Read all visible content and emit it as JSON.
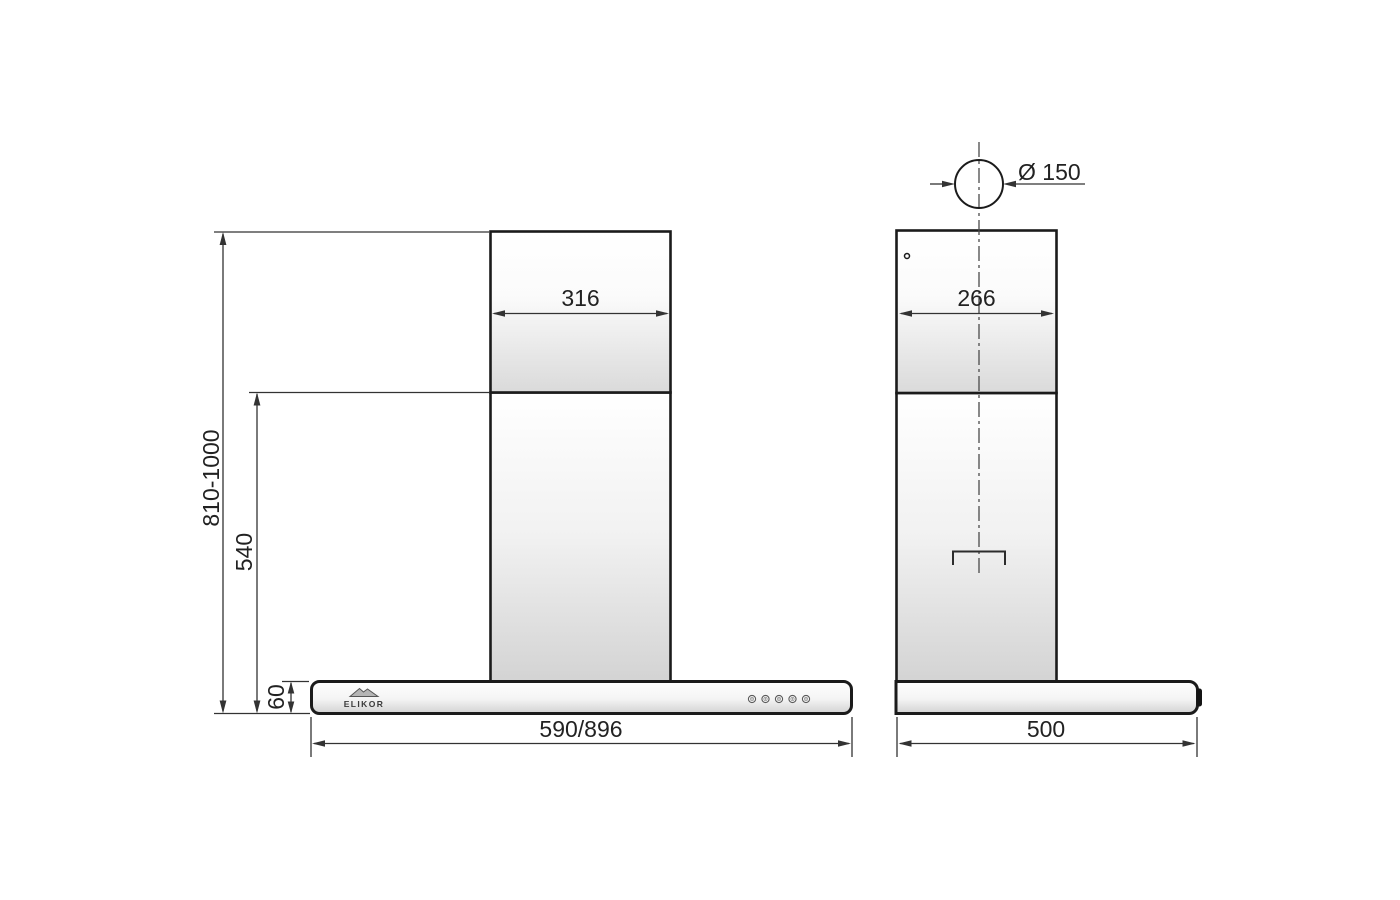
{
  "drawing": {
    "brand": "ELIKOR"
  },
  "front_view": {
    "chimney_width": "316",
    "height_range": "810-1000",
    "chimney_height": "540",
    "body_height": "60",
    "body_width": "590/896",
    "button_count": 5
  },
  "side_view": {
    "outlet_diameter": "Ø 150",
    "chimney_depth": "266",
    "body_depth": "500"
  },
  "colors": {
    "line_color": "#1b1b1b",
    "dim_color": "#333333",
    "text_color": "#222222",
    "shade_color": "#d3d3d3",
    "background": "#ffffff"
  }
}
